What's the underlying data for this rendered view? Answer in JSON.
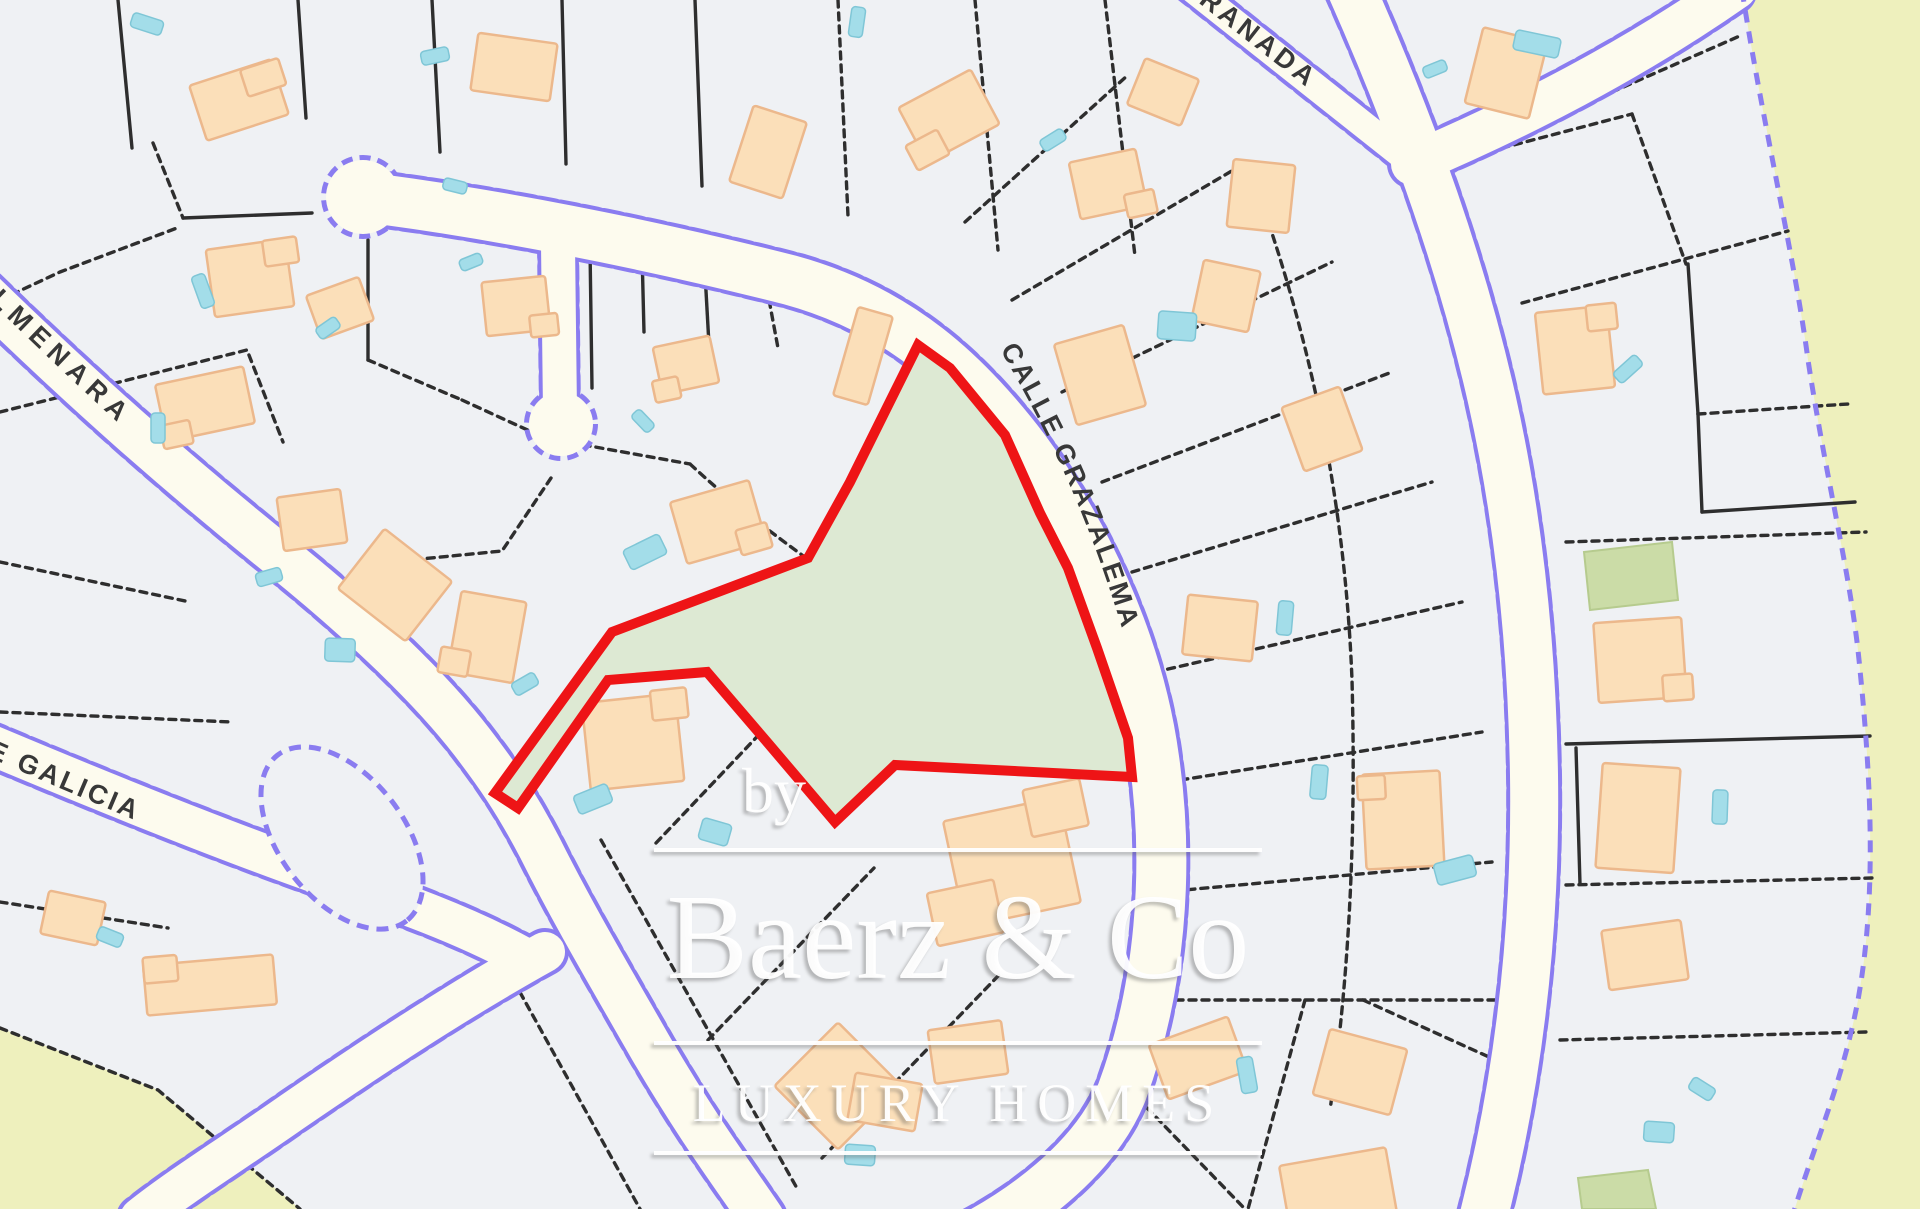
{
  "colors": {
    "bg": "#eff1f4",
    "road": "#fdfbee",
    "purple": "#8a7cf0",
    "parcel_line": "#2e2e2e",
    "building_fill": "#fbdfb9",
    "building_stroke": "#ecb88c",
    "pool_fill": "#a3dde9",
    "pool_stroke": "#7fc6d6",
    "plot_fill": "#dde9d3",
    "plot_stroke": "#ee1416",
    "olive_fill": "#cbdca7",
    "olive_stroke": "#b6cb8e",
    "yellow": "#eef0bd",
    "label": "#383838"
  },
  "map": {
    "plot": {
      "points": "918,345 950,368 1005,435 1040,513 1068,568 1097,648 1128,738 1132,777 895,765 835,822 767,742 707,672 608,680 518,808 495,793 612,632 808,558 850,482",
      "stroke_width": 10
    },
    "roads": [
      {
        "d": "M 363,197 C 490,213 640,242 790,280 C 900,310 968,375 1025,450 C 1082,527 1138,640 1154,758 C 1170,868 1160,990 1122,1092 C 1095,1160 1020,1215 950,1248",
        "w": 50
      },
      {
        "d": "M 558,244 L 560,412",
        "w": 34
      },
      {
        "d": "M 1186,-16 L 1418,168",
        "w": 27
      },
      {
        "d": "M 1412,164 C 1520,118 1630,62 1736,-12",
        "w": 42
      },
      {
        "d": "M 1349,-16 C 1394,85 1455,235 1492,400 C 1520,525 1532,650 1534,775 C 1536,915 1522,1065 1484,1215",
        "w": 48
      },
      {
        "d": "M -16,294 C 85,392 175,472 282,558 C 365,625 432,690 472,742 C 495,772 515,800 540,848 C 572,912 605,968 652,1050 C 700,1132 735,1178 762,1218",
        "w": 44
      },
      {
        "d": "M -16,742 C 110,795 230,843 330,878 C 400,902 465,925 525,958",
        "w": 40
      },
      {
        "d": "M 545,952 C 455,1002 365,1062 292,1112 C 235,1152 180,1186 140,1218",
        "w": 40
      }
    ],
    "bulbs": [
      {
        "cx": 363,
        "cy": 197,
        "r": 37
      },
      {
        "cx": 561,
        "cy": 424,
        "r": 32
      }
    ],
    "island": {
      "cx": 342,
      "cy": 838,
      "rx": 105,
      "ry": 62,
      "rot": 52
    },
    "boundary": {
      "d": "M 1742,-10 C 1762,120 1795,260 1808,360 C 1828,490 1852,580 1860,670 C 1872,790 1876,900 1858,1000 C 1842,1085 1812,1150 1792,1218"
    },
    "yellow_areas": [
      "M 1742,-10 C 1762,120 1795,260 1808,360 C 1828,490 1852,580 1860,670 C 1872,790 1876,900 1858,1000 C 1842,1085 1812,1150 1792,1218 L 1930,1218 L 1930,-10 Z",
      "M 0,1028 L 158,1090 L 300,1209 L 0,1209 Z"
    ],
    "olive_parcels": [
      "M 1584,552 L 1672,542 L 1678,600 L 1590,610 Z",
      "M 1578,1178 L 1648,1170 L 1656,1209 L 1582,1209 Z"
    ],
    "parcel_lines": [
      {
        "d": "M 118,0 L 132,148",
        "solid": true
      },
      {
        "d": "M 298,0 L 306,118",
        "solid": true
      },
      {
        "d": "M 432,0 L 440,152",
        "solid": true
      },
      {
        "d": "M 562,0 L 566,164",
        "solid": true
      },
      {
        "d": "M 695,0 L 702,186",
        "solid": true
      },
      {
        "d": "M 838,0 L 848,216",
        "solid": false
      },
      {
        "d": "M 975,0 L 998,250",
        "solid": false
      },
      {
        "d": "M 1105,0 L 1135,256",
        "solid": false
      },
      {
        "d": "M 153,143 L 183,218",
        "solid": false
      },
      {
        "d": "M 183,218 L 312,213",
        "solid": true
      },
      {
        "d": "M 0,300 L 60,272 L 177,228",
        "solid": false
      },
      {
        "d": "M 368,240 L 368,360",
        "solid": true
      },
      {
        "d": "M 368,360 L 462,400",
        "solid": false
      },
      {
        "d": "M 0,412 L 247,350 L 283,442",
        "solid": false
      },
      {
        "d": "M 0,562 L 190,602",
        "solid": false
      },
      {
        "d": "M 0,712 L 232,722",
        "solid": false
      },
      {
        "d": "M 0,902 L 168,928",
        "solid": false
      },
      {
        "d": "M 0,1028 L 158,1090 L 300,1209",
        "solid": false
      },
      {
        "d": "M 590,248 L 592,388",
        "solid": true
      },
      {
        "d": "M 462,400 L 545,438 L 690,464",
        "solid": false
      },
      {
        "d": "M 690,464 C 740,510 775,535 806,558",
        "solid": false
      },
      {
        "d": "M 704,255 L 709,345",
        "solid": true
      },
      {
        "d": "M 762,262 L 778,348",
        "solid": false
      },
      {
        "d": "M 642,252 L 644,332",
        "solid": true
      },
      {
        "d": "M 551,478 L 502,551 L 390,562",
        "solid": false
      },
      {
        "d": "M 390,562 L 346,636",
        "solid": false
      },
      {
        "d": "M 656,843 L 790,702",
        "solid": false
      },
      {
        "d": "M 708,1040 L 874,868",
        "solid": false
      },
      {
        "d": "M 822,1158 L 1000,974",
        "solid": false
      },
      {
        "d": "M 601,840 L 798,1190",
        "solid": false
      },
      {
        "d": "M 501,958 L 640,1209",
        "solid": false
      },
      {
        "d": "M 965,222 L 1128,75",
        "solid": false
      },
      {
        "d": "M 1012,300 L 1247,162",
        "solid": false
      },
      {
        "d": "M 1062,392 L 1332,262",
        "solid": false
      },
      {
        "d": "M 1102,482 L 1392,372",
        "solid": false
      },
      {
        "d": "M 1132,572 L 1432,482",
        "solid": false
      },
      {
        "d": "M 1155,672 L 1462,602",
        "solid": false
      },
      {
        "d": "M 1168,782 L 1482,732",
        "solid": false
      },
      {
        "d": "M 1162,892 L 1492,862",
        "solid": false
      },
      {
        "d": "M 1150,1000 L 1495,1000",
        "solid": false
      },
      {
        "d": "M 1120,1080 L 1245,1209",
        "solid": false
      },
      {
        "d": "M 1305,1000 L 1248,1209",
        "solid": false
      },
      {
        "d": "M 1363,1000 L 1500,1062",
        "solid": false
      },
      {
        "d": "M 1247,162 C 1310,330 1345,500 1352,680 C 1356,830 1350,970 1330,1110",
        "solid": false
      },
      {
        "d": "M 1612,92 L 1742,35",
        "solid": false
      },
      {
        "d": "M 1502,148 L 1632,114",
        "solid": false
      },
      {
        "d": "M 1632,114 L 1686,264",
        "solid": false
      },
      {
        "d": "M 1522,303 L 1788,231",
        "solid": false
      },
      {
        "d": "M 1688,264 L 1698,414",
        "solid": true
      },
      {
        "d": "M 1698,414 L 1848,404",
        "solid": false
      },
      {
        "d": "M 1698,414 L 1702,512",
        "solid": true
      },
      {
        "d": "M 1702,512 L 1855,502",
        "solid": true
      },
      {
        "d": "M 1566,542 L 1866,532",
        "solid": false
      },
      {
        "d": "M 1566,744 L 1870,736",
        "solid": true
      },
      {
        "d": "M 1576,748 L 1580,884",
        "solid": true
      },
      {
        "d": "M 1566,885 L 1872,878",
        "solid": false
      },
      {
        "d": "M 1560,1040 L 1866,1032",
        "solid": false
      }
    ],
    "buildings": [
      [
        239,
        100,
        86,
        58,
        -18,
        [
          [
            30,
            -14,
            40,
            28
          ]
        ]
      ],
      [
        514,
        67,
        80,
        58,
        8,
        []
      ],
      [
        768,
        152,
        56,
        80,
        18,
        []
      ],
      [
        949,
        116,
        82,
        62,
        -28,
        [
          [
            -35,
            20,
            36,
            28
          ]
        ]
      ],
      [
        1163,
        92,
        58,
        50,
        22,
        []
      ],
      [
        1261,
        196,
        62,
        68,
        6,
        []
      ],
      [
        1506,
        73,
        66,
        78,
        14,
        []
      ],
      [
        250,
        278,
        80,
        68,
        -8,
        [
          [
            34,
            -22,
            34,
            26
          ]
        ]
      ],
      [
        205,
        404,
        90,
        58,
        -12,
        [
          [
            -34,
            24,
            30,
            24
          ]
        ]
      ],
      [
        312,
        520,
        64,
        54,
        -8,
        []
      ],
      [
        395,
        585,
        86,
        76,
        38,
        []
      ],
      [
        487,
        637,
        66,
        82,
        10,
        [
          [
            -28,
            30,
            30,
            26
          ]
        ]
      ],
      [
        516,
        306,
        64,
        54,
        -6,
        [
          [
            26,
            22,
            28,
            22
          ]
        ]
      ],
      [
        686,
        365,
        58,
        48,
        -12,
        [
          [
            -24,
            20,
            26,
            22
          ]
        ]
      ],
      [
        718,
        522,
        82,
        64,
        -16,
        [
          [
            30,
            26,
            32,
            26
          ]
        ]
      ],
      [
        863,
        356,
        36,
        92,
        16,
        []
      ],
      [
        633,
        742,
        94,
        88,
        -6,
        [
          [
            40,
            -34,
            36,
            30
          ]
        ]
      ],
      [
        210,
        985,
        130,
        50,
        -5,
        [
          [
            -48,
            -20,
            34,
            26
          ]
        ]
      ],
      [
        73,
        918,
        58,
        44,
        12,
        []
      ],
      [
        340,
        308,
        56,
        46,
        -20,
        []
      ],
      [
        1012,
        862,
        118,
        108,
        -12,
        [
          [
            -56,
            40,
            68,
            54
          ],
          [
            54,
            -44,
            58,
            48
          ]
        ]
      ],
      [
        838,
        1086,
        90,
        90,
        45,
        []
      ],
      [
        968,
        1052,
        74,
        54,
        -8,
        []
      ],
      [
        885,
        1102,
        68,
        48,
        10,
        []
      ],
      [
        1100,
        375,
        72,
        84,
        -16,
        []
      ],
      [
        1220,
        628,
        70,
        60,
        6,
        []
      ],
      [
        1108,
        184,
        68,
        58,
        -12,
        [
          [
            28,
            26,
            30,
            24
          ]
        ]
      ],
      [
        1226,
        296,
        58,
        62,
        12,
        []
      ],
      [
        1322,
        429,
        62,
        68,
        -20,
        []
      ],
      [
        1403,
        820,
        78,
        95,
        -3,
        [
          [
            -30,
            -34,
            28,
            24
          ]
        ]
      ],
      [
        1198,
        1058,
        84,
        58,
        -20,
        []
      ],
      [
        1360,
        1072,
        80,
        68,
        15,
        []
      ],
      [
        1339,
        1195,
        108,
        78,
        -10,
        []
      ],
      [
        1575,
        350,
        72,
        82,
        -6,
        [
          [
            30,
            -30,
            30,
            26
          ]
        ]
      ],
      [
        1640,
        660,
        88,
        80,
        -4,
        [
          [
            36,
            30,
            30,
            26
          ]
        ]
      ],
      [
        1638,
        818,
        78,
        105,
        4,
        []
      ],
      [
        1645,
        955,
        80,
        60,
        -8,
        []
      ]
    ],
    "pools": [
      [
        147,
        24,
        32,
        15,
        18
      ],
      [
        435,
        56,
        28,
        14,
        -12
      ],
      [
        857,
        22,
        14,
        30,
        8
      ],
      [
        1537,
        44,
        46,
        20,
        12
      ],
      [
        203,
        291,
        14,
        34,
        -20
      ],
      [
        328,
        328,
        24,
        13,
        -35
      ],
      [
        158,
        428,
        14,
        30,
        0
      ],
      [
        269,
        577,
        26,
        14,
        -16
      ],
      [
        340,
        650,
        30,
        23,
        2
      ],
      [
        471,
        262,
        23,
        12,
        -22
      ],
      [
        455,
        186,
        24,
        12,
        14
      ],
      [
        643,
        421,
        24,
        12,
        46
      ],
      [
        645,
        552,
        40,
        22,
        -26
      ],
      [
        525,
        684,
        26,
        14,
        -30
      ],
      [
        593,
        799,
        36,
        20,
        -22
      ],
      [
        110,
        937,
        26,
        14,
        22
      ],
      [
        715,
        832,
        30,
        22,
        16
      ],
      [
        860,
        1155,
        30,
        20,
        4
      ],
      [
        1177,
        326,
        38,
        28,
        4
      ],
      [
        1053,
        140,
        26,
        13,
        -32
      ],
      [
        1285,
        618,
        15,
        34,
        5
      ],
      [
        1319,
        782,
        16,
        34,
        5
      ],
      [
        1455,
        870,
        40,
        22,
        -15
      ],
      [
        1720,
        807,
        15,
        34,
        2
      ],
      [
        1628,
        369,
        30,
        14,
        -42
      ],
      [
        1702,
        1089,
        26,
        14,
        32
      ],
      [
        1659,
        1132,
        30,
        20,
        4
      ],
      [
        1435,
        69,
        24,
        12,
        -22
      ],
      [
        1247,
        1075,
        16,
        36,
        -10
      ]
    ],
    "street_labels": [
      {
        "id": "lp1",
        "text": "CALLE GRAZALEMA",
        "d": "M 998,346 C 1046,428 1092,520 1130,656",
        "size": 27,
        "spacing": 2.5,
        "offset": 4
      },
      {
        "id": "lp2",
        "text": "GRANADA",
        "d": "M 1172,-18 L 1425,180",
        "size": 27,
        "spacing": 4,
        "offset": 8
      },
      {
        "id": "lp3",
        "text": "ALMENARA",
        "d": "M -30,282 C 55,365 135,440 245,538",
        "size": 27,
        "spacing": 7,
        "offset": 0
      },
      {
        "id": "lp4",
        "text": "E GALICIA",
        "d": "M -14,756 C 95,804 195,845 310,894",
        "size": 27,
        "spacing": 3,
        "offset": 0
      }
    ]
  },
  "watermark": {
    "by": "by",
    "brand": "Baerz & Co",
    "tagline": "LUXURY HOMES"
  }
}
